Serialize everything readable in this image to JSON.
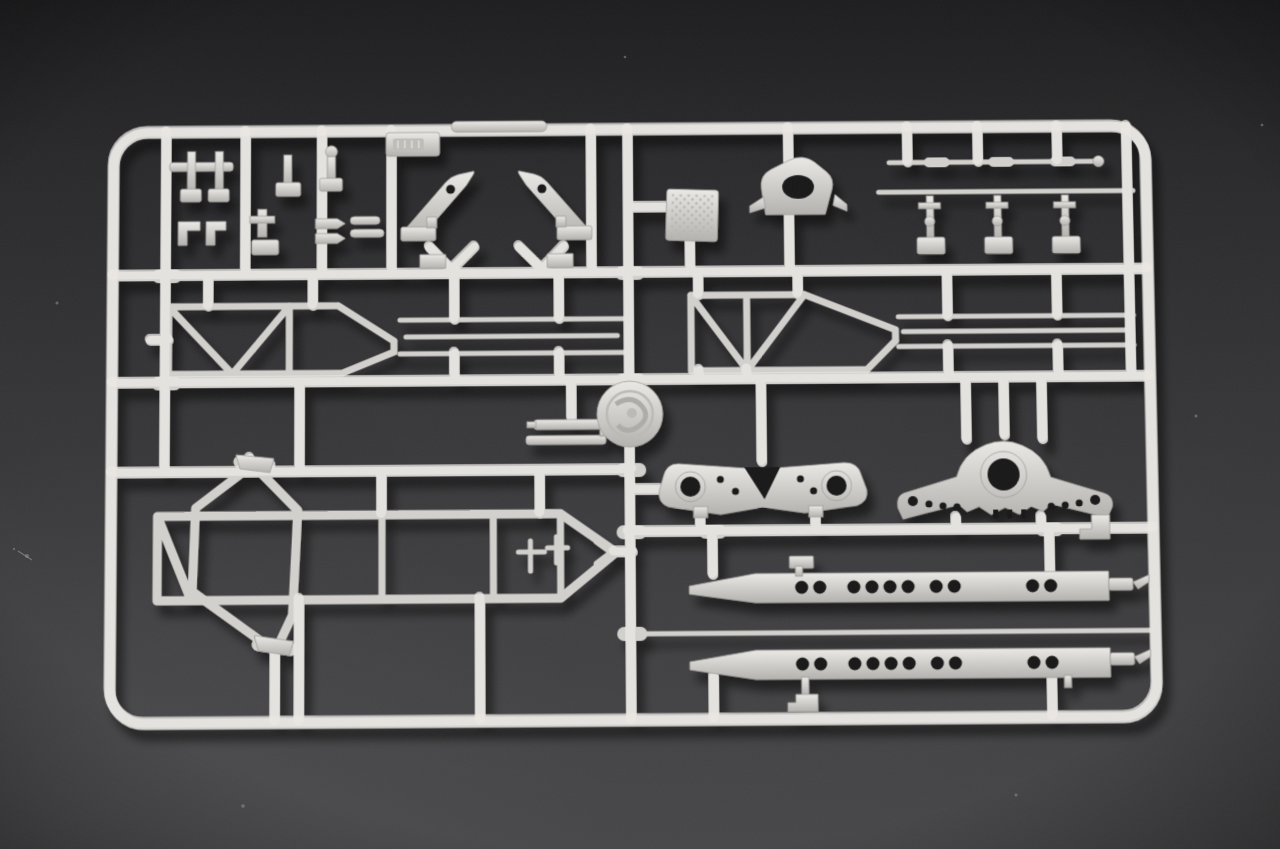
{
  "meta": {
    "title": "Plastic model kit sprue - silver-gray injection-molded parts tree",
    "description": "Photograph of a rectangular silver-gray plastic sprue (parts tree) from a scale model kit lying on a dark charcoal textured surface. The rounded frame holds a grid of runners carrying dozens of unpainted parts: small brackets and blocks, two mirrored lever arms with pivot holes, a dimpled tread plate, a bracket with a large oval opening, thin axle rods with collars, two tapered lattice truss frames with parallel rods, a circular maker's medallion at the central runner junction, a leaning hexagonal ring frame, a long ladder trail frame ending in a point, a flat equalizer beam with two ringed holes, a winged mount with a large central bearing hole, and two long tapered side plates pierced by rows of round holes.",
    "kind": "photograph",
    "background_desc": "dark charcoal flocked textured surface with soft vignette and faint dust specks"
  },
  "palette": {
    "background_top": "#1d1d1f",
    "background_upper": "#2a2a2c",
    "background_mid": "#3a3a3c",
    "background_bottom": "#4b4b4d",
    "plastic_highlight": "#eceae6",
    "plastic_base": "#d3d1cd",
    "plastic_shadow": "#b4b2ae",
    "plastic_edge": "#9f9d99",
    "emboss_dark": "#bfbdb9",
    "emboss_ridge": "#d8d6d2",
    "relief_dark": "#aeaca8",
    "relief_mid": "#bcbab6",
    "dot_texture": "#b7b5b1",
    "hole_dark": "#161618",
    "cast_shadow": "#000000"
  },
  "sprue": {
    "frame_desc": "rounded rectangular outer runner frame of light gray plastic",
    "medallion_desc": "embossed circular maker's medallion at the central runner junction",
    "label_tab_desc": "small embossed identification tab (lettering illegible)",
    "parts": [
      {
        "name": "top-edge-bar",
        "desc": "slim capsule bar molded along the top frame edge"
      },
      {
        "name": "bracket-cluster",
        "desc": "cluster of small brackets, posts, pins and blocks in the top-left bays"
      },
      {
        "name": "claw-lever-left",
        "desc": "angled lever arm with pivot hole, left-hand"
      },
      {
        "name": "claw-lever-right",
        "desc": "angled lever arm with pivot hole, right-hand mirrored"
      },
      {
        "name": "tread-plate",
        "desc": "small square plate with dimpled tread texture"
      },
      {
        "name": "towing-bracket",
        "desc": "rounded bracket with a large oval opening"
      },
      {
        "name": "axle-rod",
        "desc": "long thin axle rod attached below the top edge"
      },
      {
        "name": "linkage-row",
        "desc": "row of small linkage levers with ball ends and base blocks"
      },
      {
        "name": "truss-frame-left",
        "desc": "tapered lattice truss frame, left half of the middle band"
      },
      {
        "name": "truss-frame-right",
        "desc": "tapered lattice truss frame, right half of the middle band"
      },
      {
        "name": "rod-set-left",
        "desc": "three short parallel thin rods beside the left truss"
      },
      {
        "name": "rod-set-right",
        "desc": "three long parallel thin rods running to the right edge"
      },
      {
        "name": "center-bars",
        "desc": "two stacked flat bars with end caps near the medallion"
      },
      {
        "name": "hex-ring",
        "desc": "large leaning hexagonal ring frame in the lower left"
      },
      {
        "name": "trail-frame",
        "desc": "long ladder frame converging to a pointed tow eye"
      },
      {
        "name": "equalizer-beam",
        "desc": "flat beam with two large ringed holes and a central V notch"
      },
      {
        "name": "winged-mount",
        "desc": "winged mount with a large central bearing hole and toothed base"
      },
      {
        "name": "side-plate-upper",
        "desc": "long tapered side plate pierced by a row of round holes"
      },
      {
        "name": "side-plate-lower",
        "desc": "long tapered side plate pierced by a row of round holes"
      },
      {
        "name": "deck-rod",
        "desc": "thin straight rod spanning between the two side plates"
      },
      {
        "name": "small-flags",
        "desc": "small tab parts hanging from the lower runners"
      },
      {
        "name": "collar-caps",
        "desc": "sleeve collars and an end cap on the axle rod"
      }
    ]
  }
}
